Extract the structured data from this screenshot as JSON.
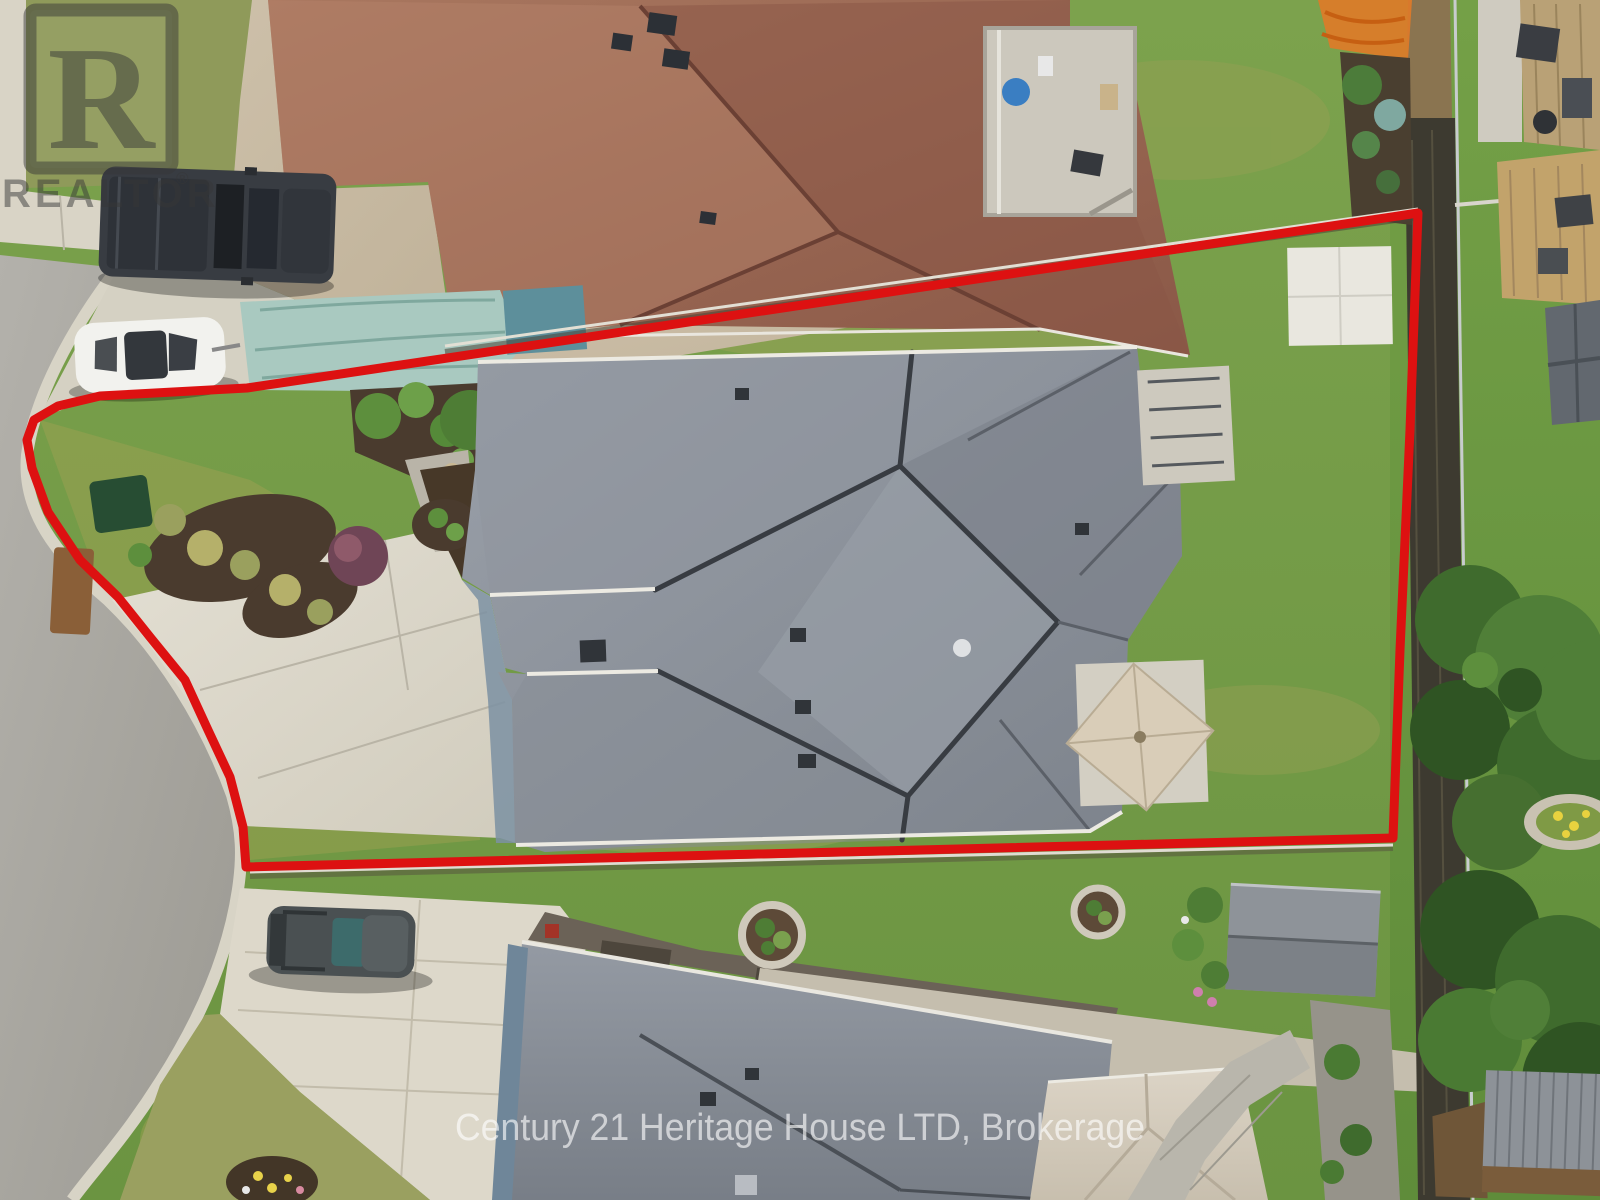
{
  "watermark": {
    "logo_letter": "R",
    "realtor_label": "REALTOR",
    "registered_symbol": "®",
    "brokerage": "Century 21 Heritage House LTD, Brokerage"
  },
  "colors": {
    "boundary": "#dd1111",
    "watermark_text": "rgba(255,255,255,0.62)",
    "logo_gray": "rgba(55,55,55,0.52)"
  }
}
